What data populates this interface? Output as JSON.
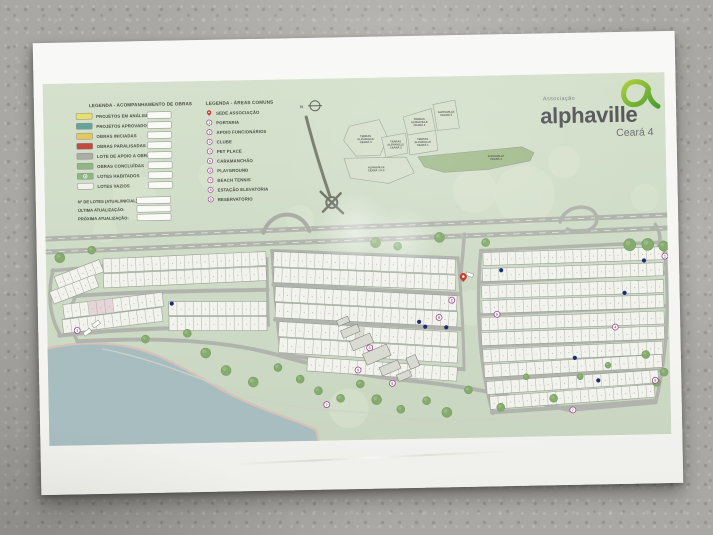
{
  "palette": {
    "map_bg_top": "#d5e1cc",
    "map_bg_bottom": "#c9d6c1",
    "road": "#b0b4ac",
    "lot_fill": "#f2f3ed",
    "lot_stroke": "#989e96",
    "tree": "#85ab6f",
    "water": "#a8bdc0",
    "sand": "#d8c1b7",
    "marker_purple": "#9a4b8d",
    "pin_red": "#c9392f",
    "blue_dot": "#1d2b72"
  },
  "logo": {
    "association_label": "Associação",
    "brand": "alphaville",
    "region": "Ceará 4",
    "accent_green": "#7ab929"
  },
  "legend_obras": {
    "title": "LEGENDA - ACOMPANHAMENTO DE OBRAS",
    "items": [
      {
        "label": "PROJETOS EM ANÁLISE",
        "color": "#e9df6e",
        "marker": "swatch"
      },
      {
        "label": "PROJETOS APROVADOS",
        "color": "#66a39b",
        "marker": "swatch"
      },
      {
        "label": "OBRAS INICIADAS",
        "color": "#e6c75c",
        "marker": "swatch"
      },
      {
        "label": "OBRAS PARALISADAS",
        "color": "#c44a3d",
        "marker": "swatch"
      },
      {
        "label": "LOTE DE APOIO A OBRA",
        "color": "#abada6",
        "marker": "swatch"
      },
      {
        "label": "OBRAS CONCLUÍDAS",
        "color": "#8fb786",
        "marker": "swatch"
      },
      {
        "label": "LOTES HABITADOS",
        "color": "#8fb786",
        "marker": "swatch-ring"
      },
      {
        "label": "LOTES VAZIOS",
        "color": "#f2f3ed",
        "marker": "swatch"
      }
    ],
    "fields": [
      {
        "label": "Nº DE LOTES (ATUAL/INICIAL):"
      },
      {
        "label": "ÚLTIMA ATUALIZAÇÃO:"
      },
      {
        "label": "PRÓXIMA ATUALIZAÇÃO:"
      }
    ]
  },
  "legend_areas": {
    "title": "LEGENDA - ÁREAS COMUNS",
    "items": [
      {
        "num": "",
        "label": "SEDE ASSOCIAÇÃO",
        "marker": "pin"
      },
      {
        "num": "1",
        "label": "PORTARIA",
        "marker": "circle"
      },
      {
        "num": "2",
        "label": "APOIO FUNCIONÁRIOS",
        "marker": "circle"
      },
      {
        "num": "3",
        "label": "CLUBE",
        "marker": "circle"
      },
      {
        "num": "4",
        "label": "PET PLACE",
        "marker": "circle"
      },
      {
        "num": "5",
        "label": "CARAMANCHÃO",
        "marker": "circle"
      },
      {
        "num": "6",
        "label": "PLAYGROUND",
        "marker": "circle"
      },
      {
        "num": "7",
        "label": "BEACH TENNIS",
        "marker": "circle"
      },
      {
        "num": "8",
        "label": "ESTAÇÃO ELEVATÓRIA",
        "marker": "circle"
      },
      {
        "num": "9",
        "label": "RESERVATÓRIO",
        "marker": "circle"
      }
    ]
  },
  "overview": {
    "north_label": "N",
    "access_road": {
      "d": "M263,38 C270,68 278,95 285,117",
      "w": 3,
      "c": "#757969"
    },
    "interchange": {
      "cx": 287,
      "cy": 124
    },
    "parcels": [
      {
        "pts": "306,48 336,42 344,60 336,78 312,78 300,62",
        "label": "TERRAS ALPHAVILLE CEARÁ 3",
        "lx": 322,
        "ly": 62
      },
      {
        "pts": "338,60 362,56 364,76 342,80",
        "label": "TERRAS ALPHAVILLE CEARÁ 2",
        "lx": 352,
        "ly": 68
      },
      {
        "pts": "360,40 388,32 392,54 364,58",
        "label": "TERRAS ALPHAVILLE CEARÁ 4",
        "lx": 376,
        "ly": 46
      },
      {
        "pts": "390,28 412,24 416,52 394,54",
        "label": "ALPHAVILLE CEARÁ 5",
        "lx": 403,
        "ly": 38
      },
      {
        "pts": "364,58 392,54 394,74 366,78",
        "label": "TERRAS ALPHAVILLE CEARÁ 1",
        "lx": 379,
        "ly": 66
      },
      {
        "pts": "300,80 362,80 370,96 344,106 306,100",
        "label": "ALPHAVILLE CEARÁ 1 E 2",
        "lx": 332,
        "ly": 92
      },
      {
        "pts": "374,80 478,72 490,78 486,86 444,94 400,96 380,90",
        "label": "ALPHAVILLE CEARÁ 4",
        "lx": 452,
        "ly": 83,
        "fill": "#a3bc8d",
        "highlight": true
      }
    ]
  },
  "site": {
    "texture_blobs": [
      [
        90,
        115,
        22
      ],
      [
        170,
        95,
        16
      ],
      [
        255,
        140,
        14
      ],
      [
        330,
        70,
        18
      ],
      [
        430,
        115,
        22
      ],
      [
        520,
        88,
        16
      ],
      [
        600,
        125,
        14
      ],
      [
        350,
        212,
        24
      ],
      [
        425,
        232,
        18
      ],
      [
        60,
        148,
        12
      ],
      [
        560,
        205,
        16
      ],
      [
        300,
        330,
        20
      ],
      [
        480,
        120,
        30
      ]
    ],
    "water": {
      "fill": "M-2,266 C40,257 80,261 112,276 C148,293 166,308 196,322 C226,336 252,344 266,352 L268,362 L-2,362 Z",
      "shore": "M-2,266 C40,257 80,261 112,276 C148,293 166,308 196,322 C226,336 252,344 266,352 L268,362",
      "color": "#a8bdc0",
      "shore_color": "#d8c1b7"
    },
    "roads": [
      {
        "d": "M0,155 L622,143",
        "w": 5,
        "name": "highway-upper"
      },
      {
        "d": "M0,168 L622,156",
        "w": 5,
        "name": "highway-lower"
      },
      {
        "d": "M0,155 L622,143",
        "w": 0.8,
        "c": "#e9e9e4",
        "dash": "6 7",
        "name": "highway-centerline"
      },
      {
        "d": "M0,168 L622,156",
        "w": 0.8,
        "c": "#e9e9e4",
        "dash": "6 7",
        "name": "highway-centerline"
      },
      {
        "d": "M218,153 C226,130 256,129 264,152",
        "w": 4,
        "c": "#a8aca2",
        "name": "overpass-ramp"
      },
      {
        "d": "M515,148 C518,132 546,128 551,142 C556,156 534,162 522,155",
        "w": 3.5,
        "name": "loop-ramp"
      },
      {
        "d": "M610,152 C616,162 616,172 609,180",
        "w": 3.5,
        "name": "right-entrance"
      },
      {
        "d": "M419,158 L414,205",
        "w": 3.5,
        "name": "sede-entrance"
      },
      {
        "d": "M30,258 C20,238 22,214 40,200",
        "w": 3.5,
        "name": "left-entrance"
      },
      {
        "d": "M6,187 C70,181 150,180 221,179",
        "w": 3.5,
        "name": "alameda"
      },
      {
        "d": "M5,214 C70,209 150,210 221,210",
        "w": 4,
        "name": "alameda"
      },
      {
        "d": "M12,252 C80,245 150,247 221,245",
        "w": 4,
        "name": "alameda"
      },
      {
        "d": "M7,186 C1,208 2,232 13,251",
        "w": 3.5,
        "name": "alameda"
      },
      {
        "d": "M221,179 L221,245",
        "w": 3,
        "name": "alameda"
      },
      {
        "d": "M226,171 L412,182",
        "w": 3.5,
        "name": "alameda"
      },
      {
        "d": "M227,205 L413,218",
        "w": 4,
        "name": "alameda"
      },
      {
        "d": "M228,240 L414,253",
        "w": 4,
        "name": "alameda"
      },
      {
        "d": "M233,275 C300,285 360,291 414,293",
        "w": 4,
        "name": "alameda"
      },
      {
        "d": "M412,182 C415,220 416,260 416,294",
        "w": 3,
        "name": "alameda"
      },
      {
        "d": "M226,171 C228,210 230,250 234,276",
        "w": 3,
        "name": "alameda"
      },
      {
        "d": "M435,175 L618,170",
        "w": 3.5,
        "name": "alameda"
      },
      {
        "d": "M434,207 L620,201",
        "w": 4,
        "name": "alameda"
      },
      {
        "d": "M433,239 L620,234",
        "w": 4,
        "name": "alameda"
      },
      {
        "d": "M434,271 L619,266",
        "w": 4,
        "name": "alameda"
      },
      {
        "d": "M437,303 L615,298",
        "w": 4,
        "name": "alameda"
      },
      {
        "d": "M443,337 C500,334 560,332 607,328",
        "w": 4,
        "name": "alameda"
      },
      {
        "d": "M618,170 C623,220 621,275 607,330",
        "w": 3.5,
        "name": "alameda"
      },
      {
        "d": "M435,175 C429,230 431,290 444,338",
        "w": 3.5,
        "name": "alameda"
      },
      {
        "d": "M30,258 C110,255 180,260 232,276 C290,294 330,300 380,306 C440,314 480,326 520,336 L607,330",
        "w": 4,
        "name": "perimeter-road"
      },
      {
        "d": "M55,266 C110,278 150,298 200,316 C250,334 300,330 350,340 C400,350 460,342 560,336",
        "w": 1.2,
        "c": "#cdd1c9",
        "name": "beach-path"
      }
    ],
    "strips": [
      {
        "x": 57,
        "y": 176,
        "w": 163,
        "h": 14,
        "n": 20,
        "rot": -1.5
      },
      {
        "x": 57,
        "y": 191,
        "w": 163,
        "h": 14,
        "n": 20,
        "rot": -1.5
      },
      {
        "x": 8,
        "y": 193,
        "w": 48,
        "h": 13,
        "n": 6,
        "rot": -20
      },
      {
        "x": 3,
        "y": 208,
        "w": 48,
        "h": 13,
        "n": 6,
        "rot": -20
      },
      {
        "x": 16,
        "y": 221,
        "w": 100,
        "h": 14,
        "n": 12,
        "rot": -6,
        "tint": [
          [
            3,
            3,
            "#e4d2d5"
          ]
        ]
      },
      {
        "x": 15,
        "y": 236,
        "w": 100,
        "h": 14,
        "n": 12,
        "rot": -6
      },
      {
        "x": 122,
        "y": 220,
        "w": 98,
        "h": 14,
        "n": 12,
        "rot": 1
      },
      {
        "x": 122,
        "y": 235,
        "w": 98,
        "h": 14,
        "n": 12,
        "rot": 1
      },
      {
        "x": 228,
        "y": 172,
        "w": 182,
        "h": 15,
        "n": 22,
        "rot": 3.5
      },
      {
        "x": 228,
        "y": 188,
        "w": 182,
        "h": 15,
        "n": 22,
        "rot": 3.5
      },
      {
        "x": 229,
        "y": 207,
        "w": 182,
        "h": 15,
        "n": 22,
        "rot": 4
      },
      {
        "x": 229,
        "y": 223,
        "w": 182,
        "h": 15,
        "n": 22,
        "rot": 4
      },
      {
        "x": 232,
        "y": 242,
        "w": 179,
        "h": 15,
        "n": 21,
        "rot": 4.5,
        "tint": [
          [
            9,
            1,
            "#d9dbd3"
          ]
        ]
      },
      {
        "x": 232,
        "y": 258,
        "w": 179,
        "h": 15,
        "n": 21,
        "rot": 4.5
      },
      {
        "x": 260,
        "y": 278,
        "w": 150,
        "h": 14,
        "n": 18,
        "rot": 5
      },
      {
        "x": 437,
        "y": 177,
        "w": 180,
        "h": 13,
        "n": 22,
        "rot": -0.8
      },
      {
        "x": 436,
        "y": 193,
        "w": 181,
        "h": 13,
        "n": 22,
        "rot": -0.8
      },
      {
        "x": 435,
        "y": 210,
        "w": 182,
        "h": 13,
        "n": 22,
        "rot": -0.8
      },
      {
        "x": 435,
        "y": 225,
        "w": 182,
        "h": 13,
        "n": 22,
        "rot": -0.8
      },
      {
        "x": 434,
        "y": 242,
        "w": 183,
        "h": 13,
        "n": 22,
        "rot": -1
      },
      {
        "x": 434,
        "y": 257,
        "w": 183,
        "h": 13,
        "n": 22,
        "rot": -1
      },
      {
        "x": 435,
        "y": 274,
        "w": 180,
        "h": 13,
        "n": 22,
        "rot": -1.6
      },
      {
        "x": 436,
        "y": 289,
        "w": 178,
        "h": 13,
        "n": 21,
        "rot": -2.2
      },
      {
        "x": 438,
        "y": 306,
        "w": 172,
        "h": 13,
        "n": 21,
        "rot": -2.8
      },
      {
        "x": 441,
        "y": 321,
        "w": 165,
        "h": 13,
        "n": 20,
        "rot": -3.2
      }
    ],
    "trees": [
      [
        14,
        174,
        5
      ],
      [
        46,
        167,
        4
      ],
      [
        330,
        165,
        5
      ],
      [
        352,
        169,
        4
      ],
      [
        394,
        161,
        5
      ],
      [
        440,
        167,
        4
      ],
      [
        584,
        172,
        6
      ],
      [
        602,
        172,
        6
      ],
      [
        618,
        174,
        5
      ],
      [
        98,
        257,
        4
      ],
      [
        140,
        252,
        4
      ],
      [
        158,
        272,
        5
      ],
      [
        178,
        290,
        5
      ],
      [
        205,
        302,
        5
      ],
      [
        230,
        288,
        4
      ],
      [
        252,
        300,
        4
      ],
      [
        270,
        312,
        4
      ],
      [
        292,
        320,
        4
      ],
      [
        312,
        306,
        4
      ],
      [
        328,
        322,
        5
      ],
      [
        352,
        332,
        4
      ],
      [
        378,
        324,
        4
      ],
      [
        398,
        336,
        5
      ],
      [
        420,
        314,
        4
      ],
      [
        452,
        332,
        4
      ],
      [
        478,
        302,
        3
      ],
      [
        505,
        324,
        4
      ],
      [
        532,
        303,
        3
      ],
      [
        560,
        292,
        3
      ],
      [
        598,
        282,
        4
      ],
      [
        608,
        310,
        4
      ],
      [
        616,
        300,
        4
      ]
    ],
    "buildings": [
      [
        294,
        249,
        18,
        8,
        -22
      ],
      [
        303,
        259,
        22,
        10,
        -22
      ],
      [
        316,
        271,
        26,
        12,
        -22
      ],
      [
        332,
        286,
        20,
        9,
        -22
      ],
      [
        349,
        295,
        14,
        7,
        -22
      ],
      [
        290,
        240,
        12,
        6,
        -22
      ],
      [
        360,
        279,
        10,
        12,
        -22
      ]
    ],
    "vehicles": [
      [
        36,
        247,
        8,
        4,
        -35
      ],
      [
        45,
        239,
        8,
        4,
        -35
      ],
      [
        420,
        197,
        7,
        3.5,
        20
      ]
    ],
    "markers": [
      {
        "n": "1",
        "x": 30,
        "y": 247
      },
      {
        "n": "1",
        "x": 619,
        "y": 184
      },
      {
        "n": "2",
        "x": 405,
        "y": 224
      },
      {
        "n": "3",
        "x": 322,
        "y": 270
      },
      {
        "n": "4",
        "x": 568,
        "y": 254
      },
      {
        "n": "5",
        "x": 310,
        "y": 292
      },
      {
        "n": "5",
        "x": 450,
        "y": 239
      },
      {
        "n": "6",
        "x": 344,
        "y": 306
      },
      {
        "n": "7",
        "x": 278,
        "y": 326
      },
      {
        "n": "7",
        "x": 524,
        "y": 336
      },
      {
        "n": "8",
        "x": 392,
        "y": 241
      },
      {
        "n": "9",
        "x": 607,
        "y": 308
      }
    ],
    "blue_dots": [
      [
        125,
        222
      ],
      [
        372,
        245
      ],
      [
        378,
        250
      ],
      [
        399,
        251
      ],
      [
        598,
        188
      ],
      [
        578,
        220
      ],
      [
        527,
        284
      ],
      [
        550,
        307
      ],
      [
        455,
        195
      ]
    ],
    "sede_pin": {
      "x": 417,
      "y": 206
    }
  }
}
